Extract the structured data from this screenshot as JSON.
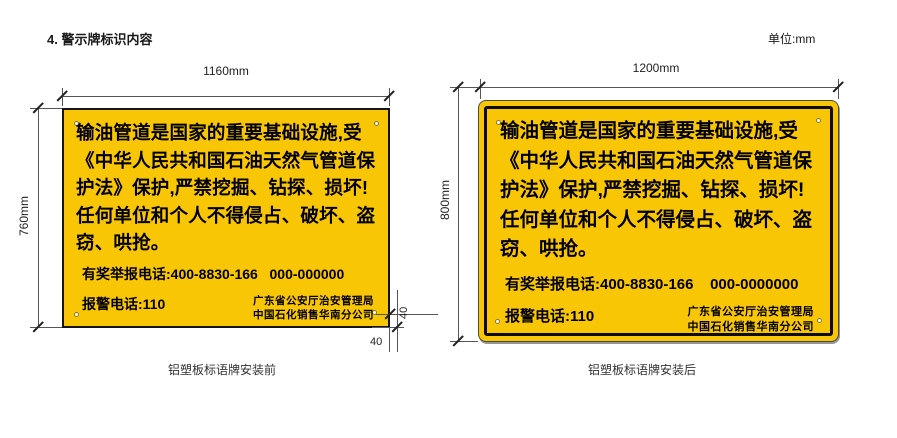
{
  "page": {
    "title": "4. 警示牌标识内容",
    "unit_label": "单位:mm"
  },
  "colors": {
    "sign_yellow": "#F9C606",
    "sign_border": "#141414",
    "dim_line": "#555555"
  },
  "signs": [
    {
      "name": "铝塑板标语牌安装前",
      "width_label": "1160mm",
      "height_label": "760mm",
      "hole_offset_h": "40",
      "hole_offset_v": "40",
      "body_lines": [
        "输油管道是国家的重要基础设施,受",
        "《中华人民共和国石油天然气管道保",
        "护法》保护,严禁挖掘、钻探、损坏!",
        "任何单位和个人不得侵占、破坏、盗",
        "窃、哄抢。"
      ],
      "hotline": "有奖举报电话:400-8830-166   000-000000",
      "police": "报警电话:110",
      "agency_line1": "广东省公安厅治安管理局",
      "agency_line2": "中国石化销售华南分公司",
      "caption": "铝塑板标语牌安装前"
    },
    {
      "name": "铝塑板标语牌安装后",
      "width_label": "1200mm",
      "height_label": "800mm",
      "body_lines": [
        "输油管道是国家的重要基础设施,受",
        "《中华人民共和国石油天然气管道保",
        "护法》保护,严禁挖掘、钻探、损坏!",
        "任何单位和个人不得侵占、破坏、盗",
        "窃、哄抢。"
      ],
      "hotline": "有奖举报电话:400-8830-166    000-0000000",
      "police": "报警电话:110",
      "agency_line1": "广东省公安厅治安管理局",
      "agency_line2": "中国石化销售华南分公司",
      "caption": "铝塑板标语牌安装后"
    }
  ]
}
